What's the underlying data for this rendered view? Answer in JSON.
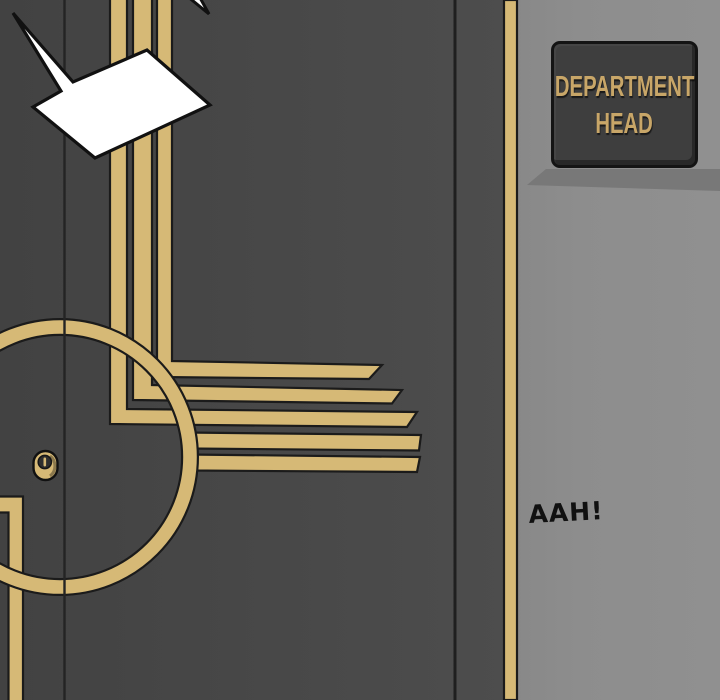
{
  "panel": {
    "description_labels": {
      "sign": {
        "line1": "DEPARTMENT",
        "line2": "HEAD"
      },
      "speech_bubble": {
        "text": "AAH!"
      }
    },
    "colors": {
      "gold": "#d6b976",
      "door_gray": "#474747",
      "wall_gray": "#8d8d8d",
      "outline": "#1b1b1b",
      "sign_bg": "#3e3e3e",
      "sign_border": "#141414",
      "sign_text": "#c8a668",
      "sign_shadow": "#747474",
      "bubble_fill": "#ffffff",
      "ink": "#111111"
    }
  }
}
